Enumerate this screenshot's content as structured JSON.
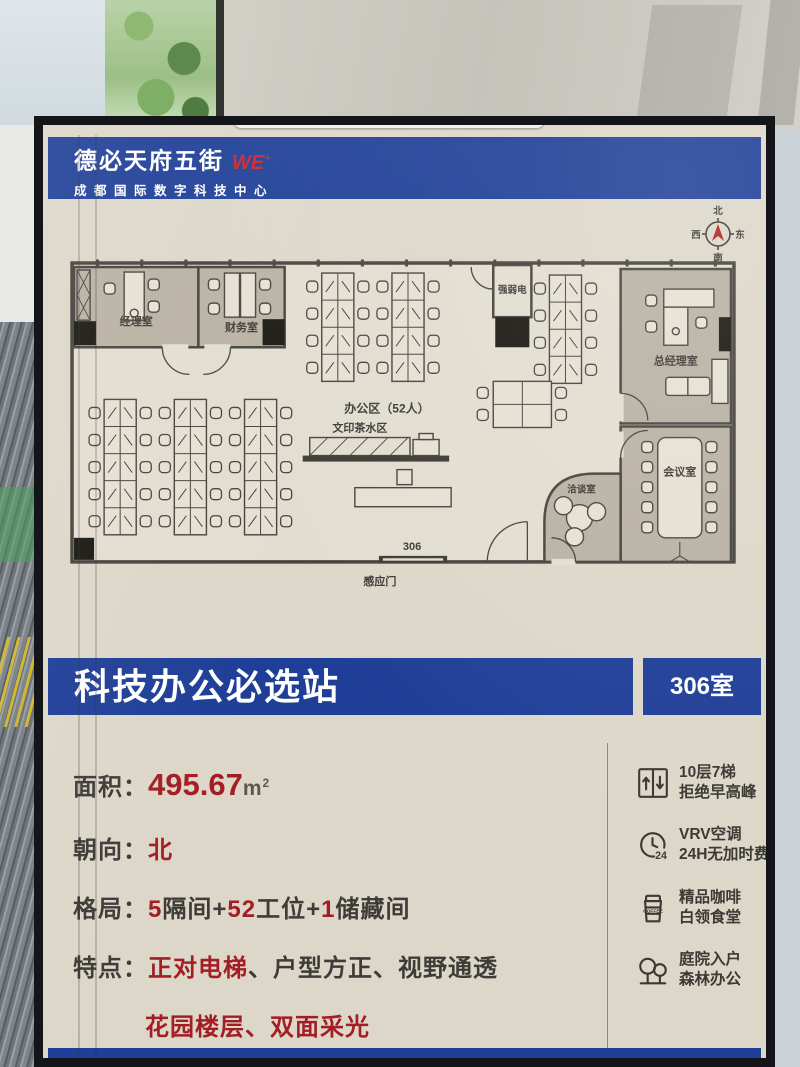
{
  "colors": {
    "blue": "#1e3e97",
    "red": "#a31e24",
    "cream": "#ddd7c9",
    "ink": "#3b3934",
    "wall": "#45423c",
    "roomfill": "#b8b1a3",
    "planfloor": "#e2ddd0",
    "desk": "#e6e0d3"
  },
  "header": {
    "brand": "德必天府五街",
    "brand_mark": "WE",
    "brand_mark_sup": "+",
    "subtitle": "成都国际数字科技中心"
  },
  "compass": {
    "north": "北",
    "west": "西",
    "east": "东",
    "south": "南"
  },
  "plan": {
    "rooms": {
      "manager": "经理室",
      "finance": "财务室",
      "office_area": "办公区（52人）",
      "utility": "强弱电",
      "gm": "总经理室",
      "print_tea": "文印茶水区",
      "negotiation": "洽谈室",
      "meeting": "会议室",
      "room_number": "306",
      "sensor_door": "感应门"
    }
  },
  "title_band": {
    "title": "科技办公必选站",
    "room_label": "306室"
  },
  "details": {
    "area": {
      "label": "面积：",
      "value": "495.67",
      "unit_base": "m",
      "unit_exp": "2"
    },
    "orientation": {
      "label": "朝向：",
      "value": "北"
    },
    "layout": {
      "label": "格局：",
      "n1": "5",
      "t1": "隔间+",
      "n2": "52",
      "t2": "工位+",
      "n3": "1",
      "t3": "储藏间"
    },
    "features": {
      "label": "特点：",
      "f1": "正对电梯",
      "rest": "、户型方正、视野通透",
      "line2": "花园楼层、双面采光"
    }
  },
  "amenities": [
    {
      "line1": "10层7梯",
      "line2": "拒绝早高峰"
    },
    {
      "line1": "VRV空调",
      "line2": "24H无加时费",
      "icon_label": "24"
    },
    {
      "line1": "精品咖啡",
      "line2": "白领食堂",
      "cup_text": "COFFEE"
    },
    {
      "line1": "庭院入户",
      "line2": "森林办公"
    }
  ]
}
